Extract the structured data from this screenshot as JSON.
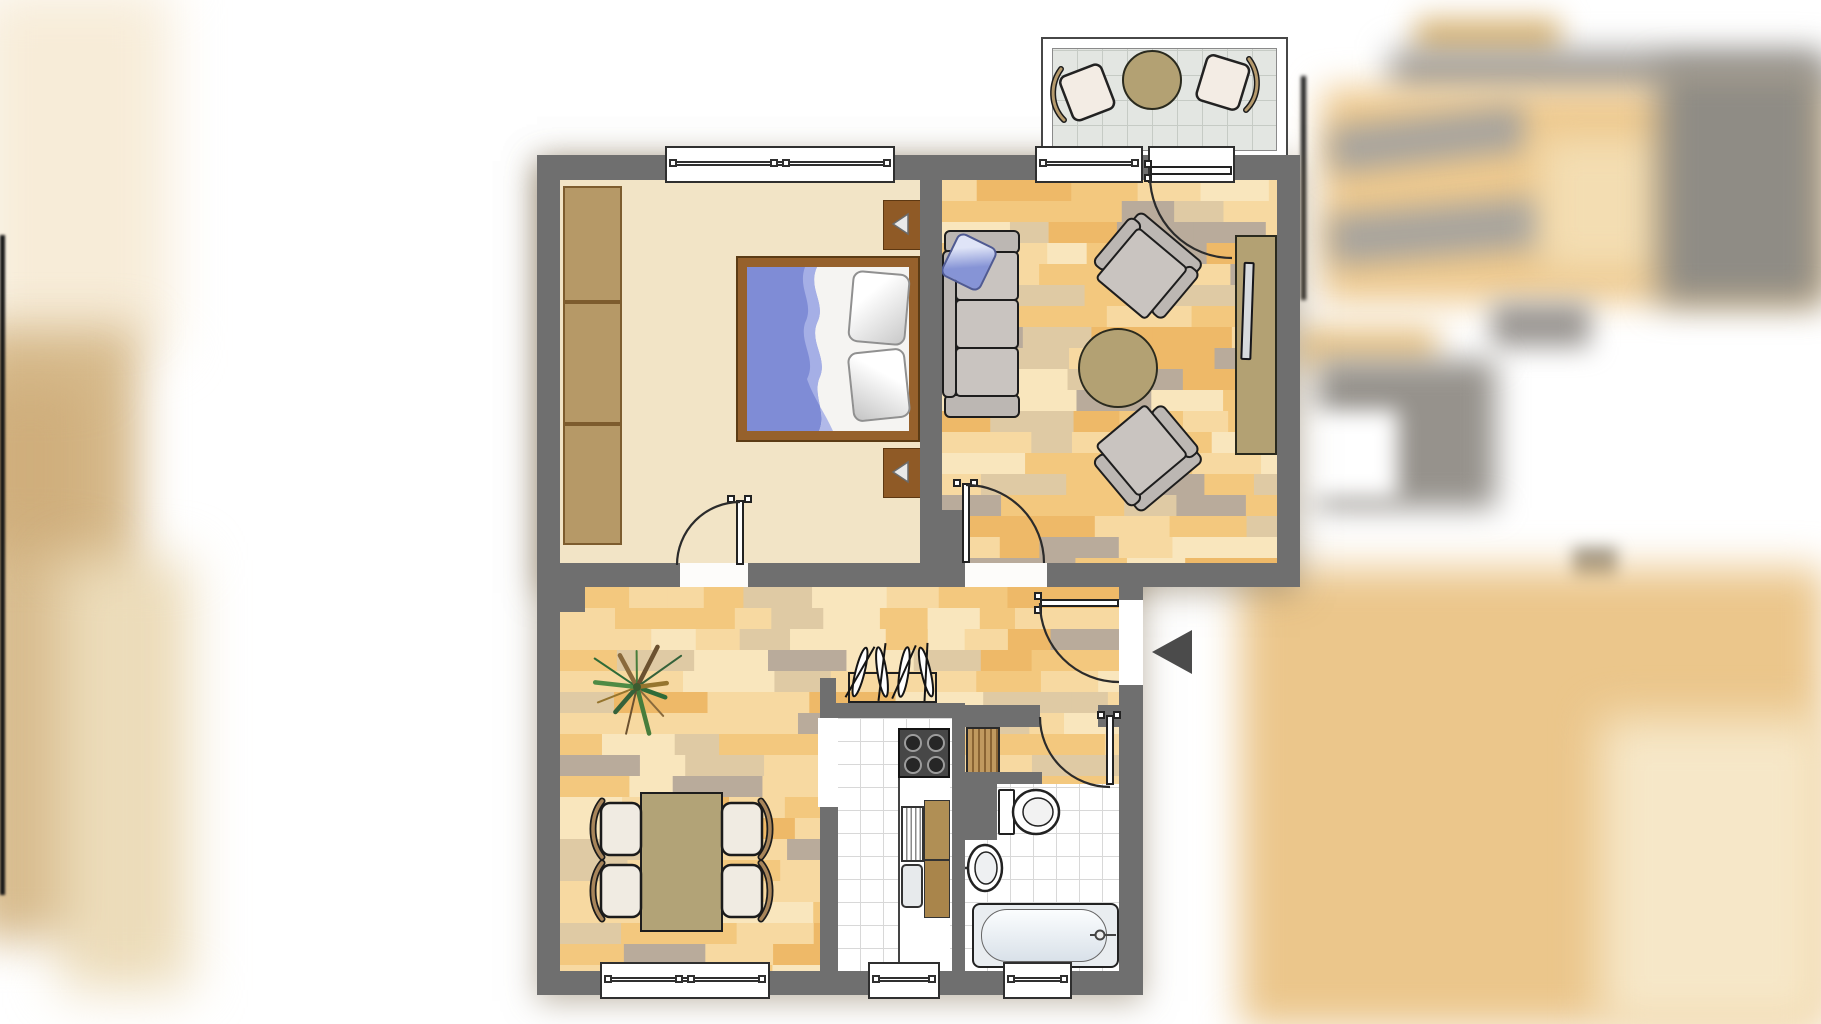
{
  "title": "apartment-floor-plan",
  "colors": {
    "wall": "#6f6f6f",
    "bedroomFloor": "#f2e4c6",
    "tanFurniture": "#b3a173",
    "wardrobe": "#b69967",
    "wardrobeBorder": "#7d5c2e",
    "bedFrame": "#96612c",
    "bedFrameEdge": "#5b3b14",
    "nightstand": "#8f5a26",
    "blanket": "#7f8cd6",
    "blanketLight": "#b7c0ec",
    "sofaGray": "#bcb7b3",
    "cushion": "#c9c4c0",
    "outline": "#1d1d1d",
    "tileLine": "#d8d8d8",
    "balconyTile": "#e3e6e2",
    "balconyTileLine": "#c6cbc5",
    "counterBrown": "#b08f55",
    "counterBrownDark": "#a9854b",
    "stove": "#474747",
    "arrow": "#4b4b4b",
    "creamChair": "#f3ece4",
    "crescent": "#a8855a",
    "parquet": [
      "#f7d9a1",
      "#f3c87e",
      "#eeb968",
      "#f9e6bd",
      "#dfcaa4",
      "#b9ab9b"
    ]
  },
  "rooms": [
    {
      "name": "bedroom",
      "floor": "cream",
      "furniture": [
        "wardrobe-3-sections",
        "double-bed",
        "blue-blanket",
        "pillow",
        "pillow",
        "nightstand-lamp",
        "nightstand-lamp"
      ],
      "openings": [
        "double-window-top",
        "door-to-hall"
      ]
    },
    {
      "name": "living-room",
      "floor": "parquet",
      "furniture": [
        "sofa-3-seat",
        "blue-cushion",
        "round-coffee-table",
        "armchair",
        "armchair",
        "sideboard-with-tv"
      ],
      "openings": [
        "window-top",
        "balcony-door",
        "door-to-hall"
      ]
    },
    {
      "name": "balcony",
      "floor": "gray-tile",
      "furniture": [
        "round-table",
        "patio-chair",
        "patio-chair"
      ]
    },
    {
      "name": "hall-dining",
      "floor": "parquet",
      "furniture": [
        "potted-plant",
        "dining-table",
        "dining-chair",
        "dining-chair",
        "dining-chair",
        "dining-chair",
        "coat-rack-hangers"
      ],
      "openings": [
        "double-window-bottom",
        "apartment-entrance-door"
      ]
    },
    {
      "name": "kitchen",
      "floor": "white-tile",
      "furniture": [
        "stove-4-burners",
        "counter-with-drainer",
        "sink",
        "cabinet",
        "cabinet"
      ],
      "openings": [
        "window-bottom",
        "open-doorway"
      ]
    },
    {
      "name": "bathroom",
      "floor": "white-tile",
      "furniture": [
        "toilet",
        "wash-basin",
        "bathtub",
        "louver-cabinet"
      ],
      "openings": [
        "window-bottom",
        "door-to-hall"
      ]
    },
    {
      "name": "entrance",
      "markers": [
        "entry-direction-arrow"
      ]
    }
  ]
}
